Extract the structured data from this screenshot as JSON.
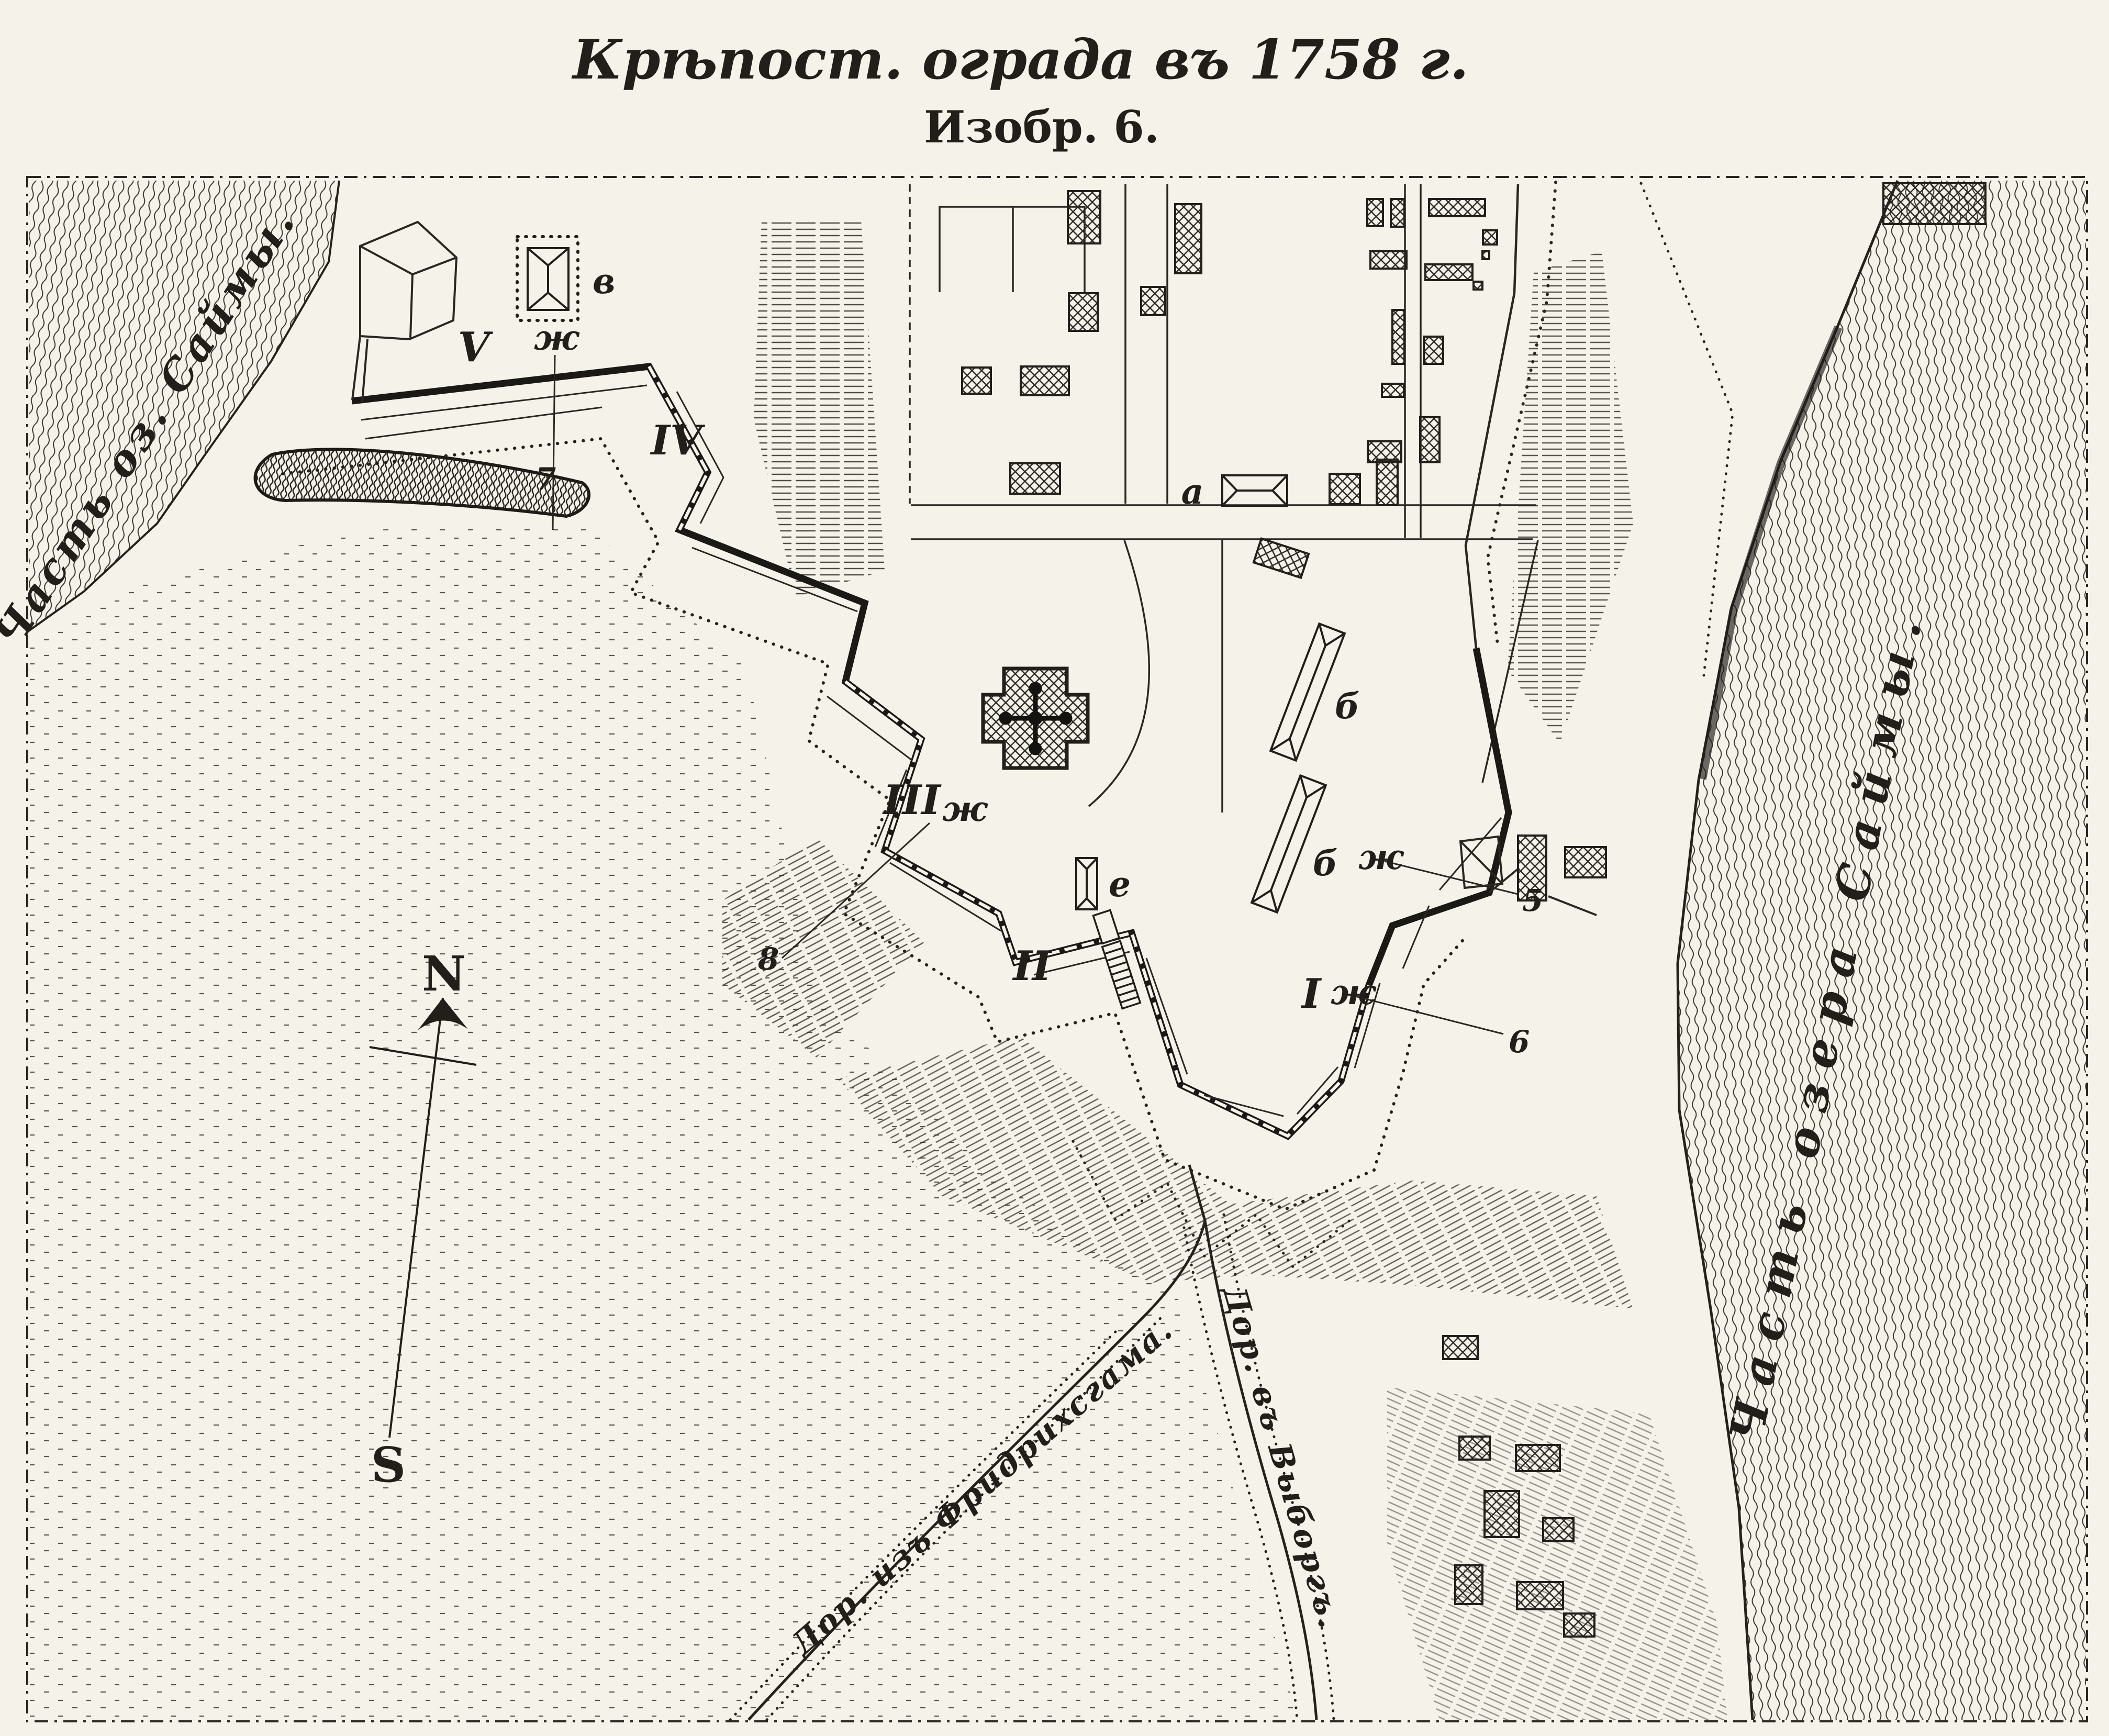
{
  "figure": {
    "title": "Крѣпост. ограда въ 1758 г.",
    "caption": "Изобр. 6."
  },
  "lake_labels": {
    "west": "Часть оз. Саймы.",
    "east": "Часть озера Саймы."
  },
  "compass": {
    "north_label": "N",
    "south_label": "S"
  },
  "bastion_numerals": {
    "b1": "I",
    "b2": "II",
    "b3": "III",
    "b4": "IV",
    "b5": "V"
  },
  "building_letters": {
    "a": "а",
    "b_upper": "б",
    "b_lower": "б",
    "v": "в",
    "e": "е"
  },
  "marker_letters": {
    "zh1": "ж",
    "zh2": "ж",
    "zh3": "ж",
    "zh4": "ж"
  },
  "point_numbers": {
    "p5": "5",
    "p6": "6",
    "p7": "7",
    "p8": "8"
  },
  "road_labels": {
    "fredrikshamn": "Дор. изъ Фридрихсгама.",
    "vyborg": "Дор. въ Выборгъ."
  },
  "colors": {
    "paper": "#f5f2ea",
    "ink": "#221f1a"
  }
}
